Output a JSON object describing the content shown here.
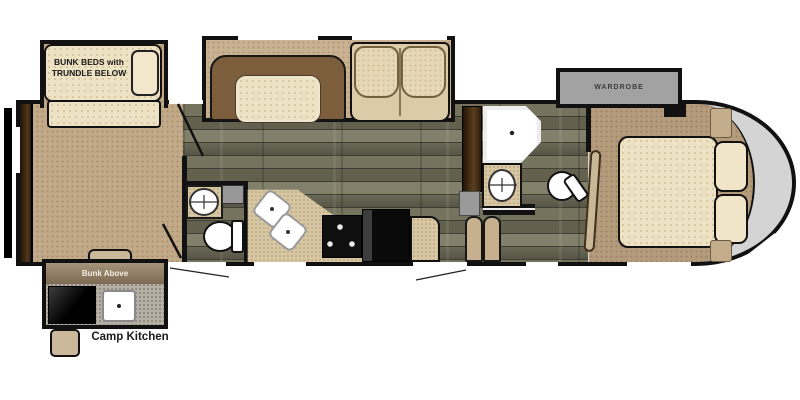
{
  "floorplan": {
    "labels": {
      "bunk_room_line1": "BUNK BEDS with",
      "bunk_room_line2": "TRUNDLE BELOW",
      "wardrobe": "WARDROBE",
      "bunk_above": "Bunk Above",
      "camp_kitchen": "Camp Kitchen"
    },
    "palette": {
      "wall": "#111111",
      "carpet": "#c2aa89",
      "bedroom_carpet": "#b49b7c",
      "wood_floor": "#6f6d5a",
      "cream_fabric": "#eee2c4",
      "booth_brown": "#7c5e3d",
      "counter_tan": "#d8c7a3",
      "slide_gray": "#a2a2a2",
      "front_cap_gray": "#d4d4d4",
      "appliance_black": "#0d0d0d",
      "cabinet_brown": "#3f2c18",
      "outdoor_kitchen_gray": "#b5afa4"
    }
  }
}
